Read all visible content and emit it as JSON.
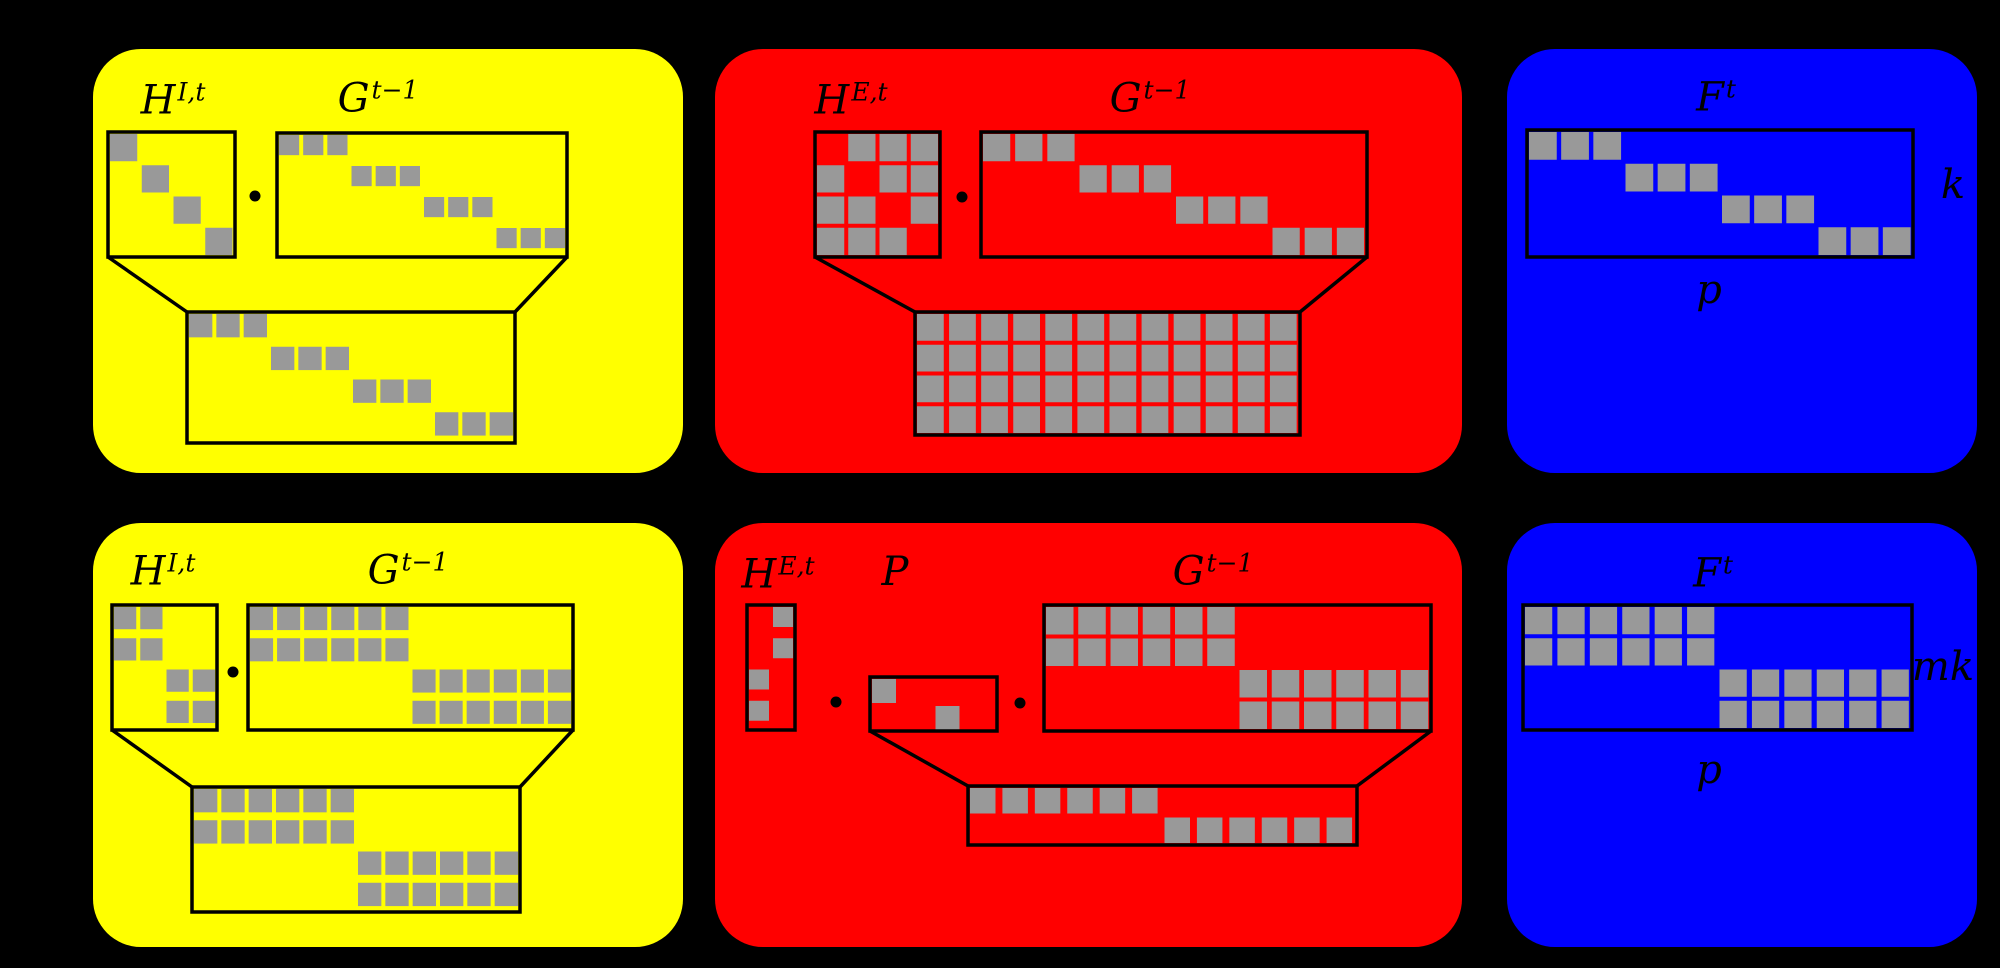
{
  "canvas": {
    "width": 2000,
    "height": 968,
    "background": "#000000"
  },
  "style": {
    "panel_radius": 48,
    "line_color": "#000000",
    "line_width": 3.5,
    "square_color": "#999999",
    "square_inset": 2,
    "square_gap": 4,
    "dot_radius": 5.5
  },
  "panels": [
    {
      "id": "top-internal-yellow",
      "color": "#ffff00",
      "x": 93,
      "y": 49,
      "w": 590,
      "h": 424,
      "labels": [
        {
          "name": "H-label",
          "base": "H",
          "sup": "I,t",
          "cx": 173,
          "cy": 100
        },
        {
          "name": "G-label",
          "base": "G",
          "sup": "t−1",
          "cx": 378,
          "cy": 98
        }
      ],
      "dots": [
        {
          "cx": 255,
          "cy": 196
        }
      ],
      "matrices": [
        {
          "name": "H-matrix",
          "x": 108,
          "y": 132,
          "w": 127,
          "h": 125,
          "rows": [
            "1000",
            "0100",
            "0010",
            "0001"
          ]
        },
        {
          "name": "G-matrix",
          "x": 277,
          "y": 133,
          "w": 290,
          "h": 124,
          "rows": [
            "111000000000",
            "000111000000",
            "000000111000",
            "000000000111"
          ]
        },
        {
          "name": "result-matrix",
          "x": 187,
          "y": 312,
          "w": 328,
          "h": 131,
          "rows": [
            "111000000000",
            "000111000000",
            "000000111000",
            "000000000111"
          ]
        }
      ],
      "connectors": [
        [
          108,
          257,
          187,
          312
        ],
        [
          567,
          257,
          515,
          312
        ]
      ]
    },
    {
      "id": "top-external-red",
      "color": "#ff0000",
      "x": 715,
      "y": 49,
      "w": 747,
      "h": 424,
      "labels": [
        {
          "name": "H-label",
          "base": "H",
          "sup": "E,t",
          "cx": 851,
          "cy": 100
        },
        {
          "name": "G-label",
          "base": "G",
          "sup": "t−1",
          "cx": 1150,
          "cy": 98
        }
      ],
      "dots": [
        {
          "cx": 962,
          "cy": 197
        }
      ],
      "matrices": [
        {
          "name": "H-matrix",
          "x": 815,
          "y": 132,
          "w": 125,
          "h": 125,
          "rows": [
            "0111",
            "1011",
            "1101",
            "1110"
          ]
        },
        {
          "name": "G-matrix",
          "x": 981,
          "y": 132,
          "w": 386,
          "h": 125,
          "rows": [
            "111000000000",
            "000111000000",
            "000000111000",
            "000000000111"
          ]
        },
        {
          "name": "result-matrix",
          "x": 915,
          "y": 312,
          "w": 385,
          "h": 123,
          "rows": [
            "111111111111",
            "111111111111",
            "111111111111",
            "111111111111"
          ]
        }
      ],
      "connectors": [
        [
          815,
          257,
          915,
          312
        ],
        [
          1367,
          257,
          1300,
          312
        ]
      ]
    },
    {
      "id": "top-forecast-blue",
      "color": "#0000ff",
      "x": 1507,
      "y": 49,
      "w": 470,
      "h": 424,
      "labels": [
        {
          "name": "F-label",
          "base": "F",
          "sup": "t",
          "cx": 1716,
          "cy": 97
        },
        {
          "name": "k-label",
          "base": "k",
          "cx": 1953,
          "cy": 185
        },
        {
          "name": "p-label",
          "base": "p",
          "cx": 1709,
          "cy": 290
        }
      ],
      "dots": [],
      "matrices": [
        {
          "name": "F-matrix",
          "x": 1527,
          "y": 130,
          "w": 386,
          "h": 127,
          "rows": [
            "111000000000",
            "000111000000",
            "000000111000",
            "000000000111"
          ]
        }
      ],
      "connectors": []
    },
    {
      "id": "bottom-internal-yellow",
      "color": "#ffff00",
      "x": 93,
      "y": 523,
      "w": 590,
      "h": 424,
      "labels": [
        {
          "name": "H-label",
          "base": "H",
          "sup": "I,t",
          "cx": 163,
          "cy": 571
        },
        {
          "name": "G-label",
          "base": "G",
          "sup": "t−1",
          "cx": 408,
          "cy": 570
        }
      ],
      "dots": [
        {
          "cx": 233,
          "cy": 672
        }
      ],
      "matrices": [
        {
          "name": "H-matrix",
          "x": 112,
          "y": 605,
          "w": 105,
          "h": 125,
          "rows": [
            "1100",
            "1100",
            "0011",
            "0011"
          ]
        },
        {
          "name": "G-matrix",
          "x": 248,
          "y": 605,
          "w": 325,
          "h": 125,
          "rows": [
            "111111000000",
            "111111000000",
            "000000111111",
            "000000111111"
          ]
        },
        {
          "name": "result-matrix",
          "x": 192,
          "y": 787,
          "w": 328,
          "h": 125,
          "rows": [
            "111111000000",
            "111111000000",
            "000000111111",
            "000000111111"
          ]
        }
      ],
      "connectors": [
        [
          112,
          730,
          192,
          787
        ],
        [
          573,
          730,
          520,
          787
        ]
      ]
    },
    {
      "id": "bottom-external-red",
      "color": "#ff0000",
      "x": 715,
      "y": 523,
      "w": 747,
      "h": 424,
      "labels": [
        {
          "name": "H-label",
          "base": "H",
          "sup": "E,t",
          "cx": 778,
          "cy": 574
        },
        {
          "name": "P-label",
          "base": "P",
          "cx": 895,
          "cy": 572
        },
        {
          "name": "G-label",
          "base": "G",
          "sup": "t−1",
          "cx": 1213,
          "cy": 571
        }
      ],
      "dots": [
        {
          "cx": 836,
          "cy": 702
        },
        {
          "cx": 1020,
          "cy": 703
        }
      ],
      "matrices": [
        {
          "name": "H-matrix",
          "x": 747,
          "y": 605,
          "w": 48,
          "h": 125,
          "rows": [
            "01",
            "01",
            "10",
            "10"
          ]
        },
        {
          "name": "P-matrix",
          "x": 870,
          "y": 677,
          "w": 127,
          "h": 54,
          "sq": 24,
          "rows": [
            "10",
            "01"
          ]
        },
        {
          "name": "G-matrix",
          "x": 1044,
          "y": 605,
          "w": 387,
          "h": 126,
          "rows": [
            "111111000000",
            "111111000000",
            "000000111111",
            "000000111111"
          ]
        },
        {
          "name": "result-matrix",
          "x": 968,
          "y": 786,
          "w": 389,
          "h": 59,
          "rows": [
            "111111000000",
            "000000111111"
          ]
        }
      ],
      "connectors": [
        [
          870,
          731,
          968,
          786
        ],
        [
          1431,
          731,
          1357,
          786
        ]
      ]
    },
    {
      "id": "bottom-forecast-blue",
      "color": "#0000ff",
      "x": 1507,
      "y": 523,
      "w": 470,
      "h": 424,
      "labels": [
        {
          "name": "F-label",
          "base": "F",
          "sup": "t",
          "cx": 1713,
          "cy": 573
        },
        {
          "name": "mk-label",
          "base": "mk",
          "cx": 1943,
          "cy": 667
        },
        {
          "name": "p-label",
          "base": "p",
          "cx": 1709,
          "cy": 770
        }
      ],
      "dots": [],
      "matrices": [
        {
          "name": "F-matrix",
          "x": 1523,
          "y": 605,
          "w": 389,
          "h": 125,
          "rows": [
            "111111000000",
            "111111000000",
            "000000111111",
            "000000111111"
          ]
        }
      ],
      "connectors": []
    }
  ]
}
